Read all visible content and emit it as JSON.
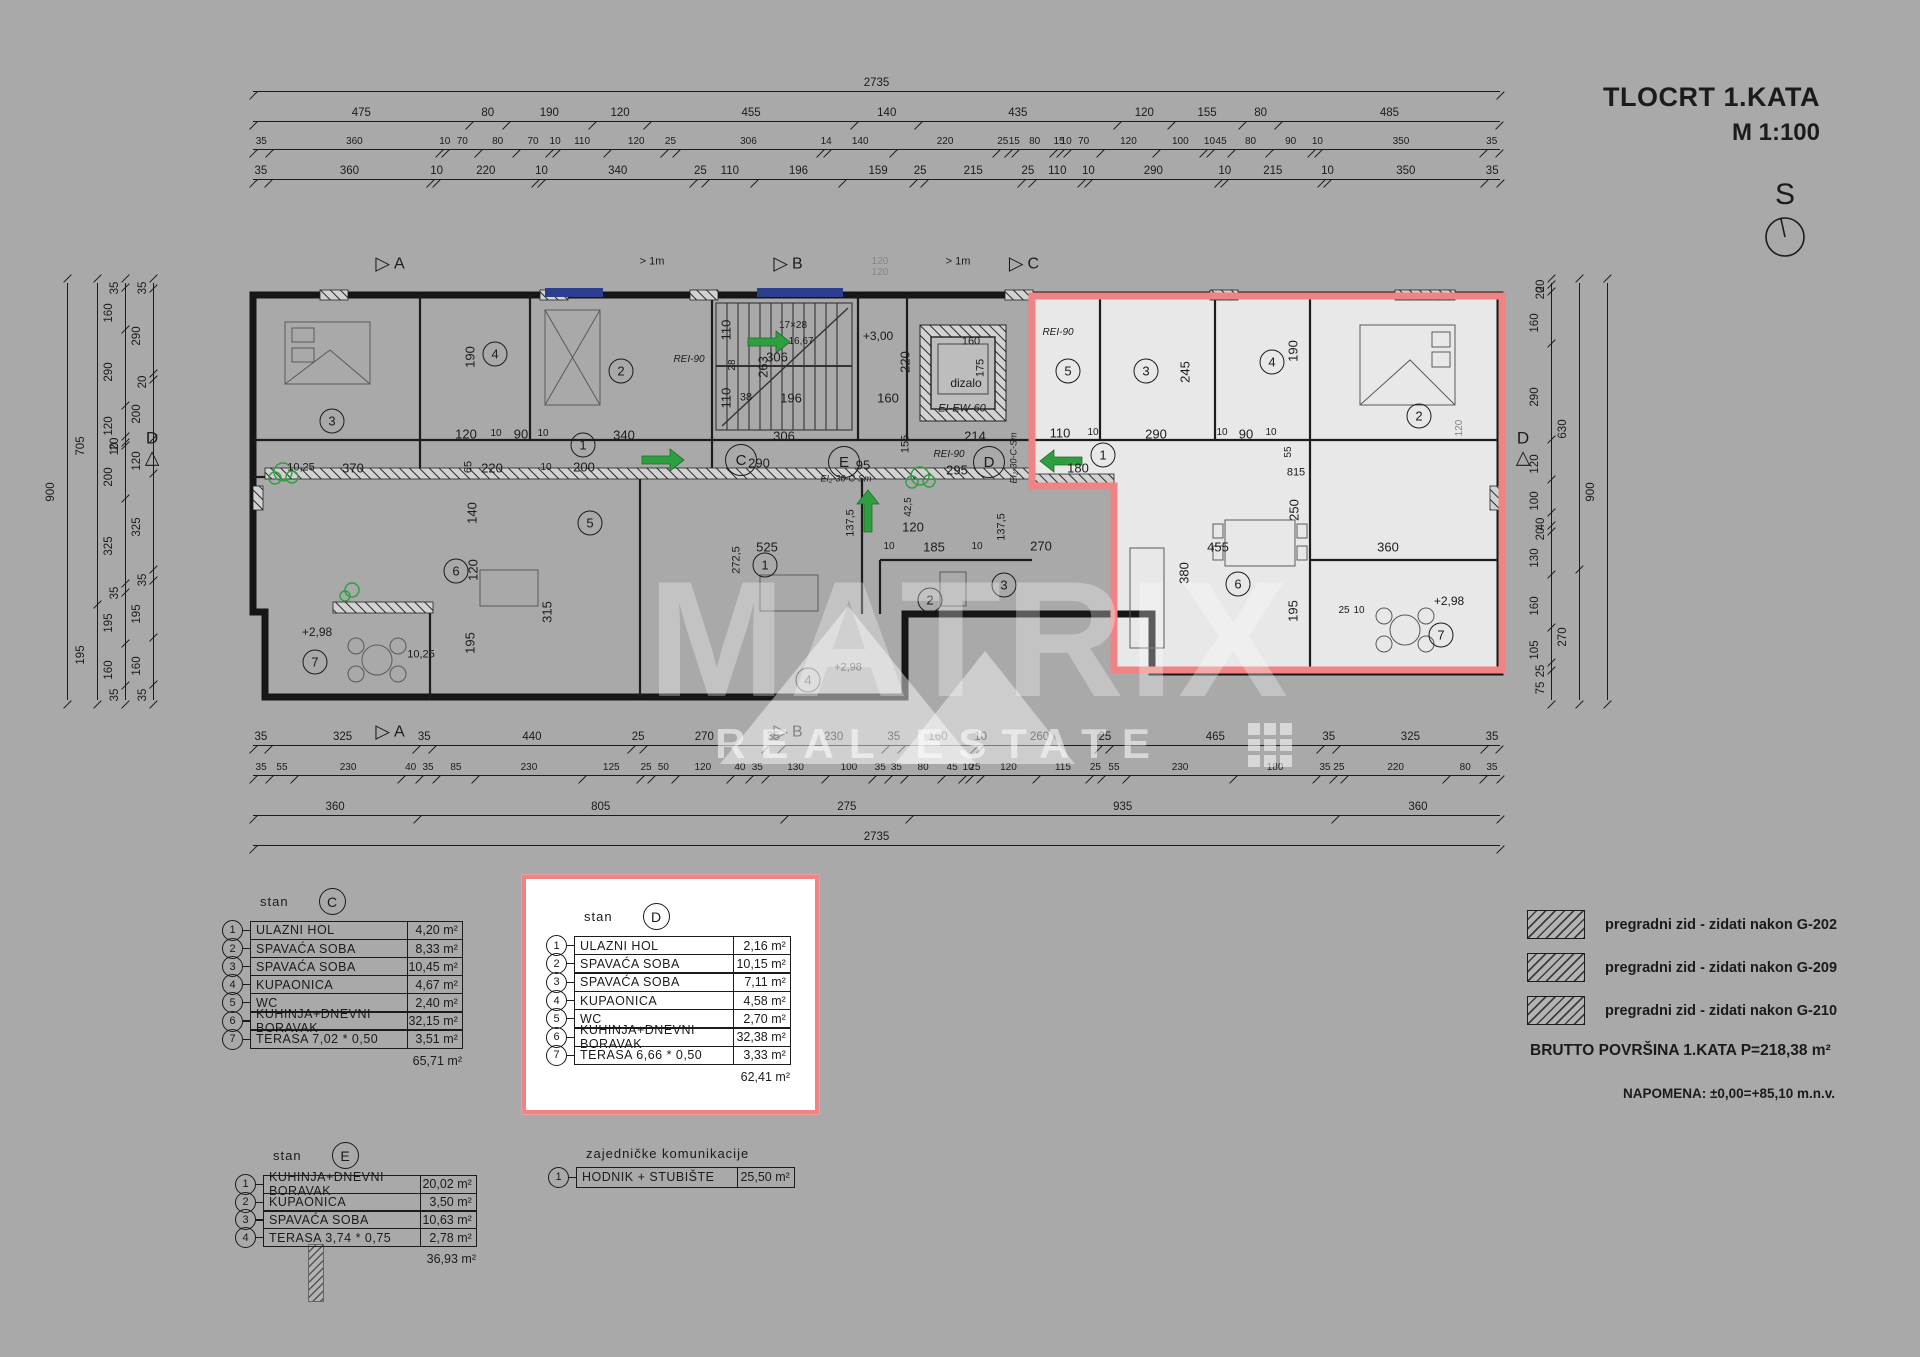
{
  "title": {
    "line1": "TLOCRT 1.KATA",
    "line2": "M 1:100"
  },
  "compass": {
    "label": "S"
  },
  "watermark": {
    "brand": "MATRIX",
    "sub": "REAL ESTATE"
  },
  "summary": {
    "brutto": "BRUTTO POVRŠINA 1.KATA  P=218,38 m²",
    "napomena": "NAPOMENA: ±0,00=+85,10 m.n.v."
  },
  "legend": {
    "items": [
      "pregradni zid - zidati nakon G-202",
      "pregradni zid - zidati nakon G-209",
      "pregradni zid - zidati nakon G-210"
    ]
  },
  "tables": [
    {
      "id": "stan-c",
      "x": 222,
      "y": 888,
      "label": "stan",
      "letter": "C",
      "red": false,
      "rowH": 19.3,
      "nameW": 158,
      "areaW": 56,
      "fs": 12.5,
      "rows": [
        [
          "1",
          "ULAZNI HOL",
          "4,20"
        ],
        [
          "2",
          "SPAVAĆA SOBA",
          "8,33"
        ],
        [
          "3",
          "SPAVAĆA SOBA",
          "10,45"
        ],
        [
          "4",
          "KUPAONICA",
          "4,67"
        ],
        [
          "5",
          "WC",
          "2,40"
        ],
        [
          "6",
          "KUHINJA+DNEVNI BORAVAK",
          "32,15"
        ],
        [
          "7",
          "TERASA 7,02 * 0,50",
          "3,51"
        ]
      ],
      "total": "65,71",
      "unit": "m²"
    },
    {
      "id": "stan-d",
      "x": 522,
      "y": 875,
      "label": "stan",
      "letter": "D",
      "red": true,
      "rowH": 19.5,
      "nameW": 160,
      "areaW": 58,
      "fs": 12.5,
      "rows": [
        [
          "1",
          "ULAZNI HOL",
          "2,16"
        ],
        [
          "2",
          "SPAVAĆA SOBA",
          "10,15"
        ],
        [
          "3",
          "SPAVAĆA SOBA",
          "7,11"
        ],
        [
          "4",
          "KUPAONICA",
          "4,58"
        ],
        [
          "5",
          "WC",
          "2,70"
        ],
        [
          "6",
          "KUHINJA+DNEVNI BORAVAK",
          "32,38"
        ],
        [
          "7",
          "TERASA 6,66 * 0,50",
          "3,33"
        ]
      ],
      "total": "62,41",
      "unit": "m²"
    },
    {
      "id": "stan-e",
      "x": 235,
      "y": 1142,
      "label": "stan",
      "letter": "E",
      "red": false,
      "rowH": 19,
      "nameW": 158,
      "areaW": 57,
      "fs": 12.5,
      "rows": [
        [
          "1",
          "KUHINJA+DNEVNI BORAVAK",
          "20,02"
        ],
        [
          "2",
          "KUPAONICA",
          "3,50"
        ],
        [
          "3",
          "SPAVAĆA SOBA",
          "10,63"
        ],
        [
          "4",
          "TERASA 3,74 * 0,75",
          "2,78"
        ]
      ],
      "total": "36,93",
      "unit": "m²"
    },
    {
      "id": "common",
      "x": 548,
      "y": 1146,
      "label": "zajedničke komunikacije",
      "letter": "",
      "red": false,
      "rowH": 21,
      "nameW": 162,
      "areaW": 58,
      "fs": 12.5,
      "rows": [
        [
          "1",
          "HODNIK + STUBIŠTE",
          "25,50"
        ]
      ],
      "total": "",
      "unit": "m²"
    }
  ],
  "dims": {
    "top": [
      {
        "y": 88,
        "segs": [
          "2735"
        ]
      },
      {
        "y": 118,
        "segs": [
          "475",
          "80",
          "190",
          "120",
          "455",
          "140",
          "435",
          "120",
          "155",
          "80",
          "485"
        ]
      },
      {
        "y": 146,
        "segs": [
          "35",
          "360",
          "10",
          "70",
          "80",
          "70",
          "10",
          "110",
          "120",
          "25",
          "306",
          "14",
          "140",
          "220",
          "25",
          "15",
          "80",
          "15",
          "10",
          "70",
          "120",
          "100",
          "10",
          "45",
          "80",
          "90",
          "10",
          "350",
          "35"
        ]
      },
      {
        "y": 176,
        "segs": [
          "35",
          "360",
          "10",
          "220",
          "10",
          "340",
          "25",
          "110",
          "196",
          "159",
          "25",
          "215",
          "25",
          "110",
          "10",
          "290",
          "10",
          "215",
          "10",
          "350",
          "35"
        ]
      }
    ],
    "bottom": [
      {
        "y": 742,
        "segs": [
          "35",
          "325",
          "35",
          "440",
          "25",
          "270",
          "35",
          "230",
          "35",
          "160",
          "10",
          "260",
          "25",
          "465",
          "35",
          "325",
          "35"
        ]
      },
      {
        "y": 772,
        "segs": [
          "35",
          "55",
          "230",
          "40",
          "35",
          "85",
          "230",
          "125",
          "25",
          "50",
          "120",
          "40",
          "35",
          "130",
          "100",
          "35",
          "35",
          "80",
          "45",
          "10",
          "25",
          "120",
          "115",
          "25",
          "55",
          "230",
          "180",
          "35",
          "25",
          "220",
          "80",
          "35"
        ]
      },
      {
        "y": 812,
        "segs": [
          "360",
          "805",
          "275",
          "935",
          "360"
        ]
      },
      {
        "y": 842,
        "segs": [
          "2735"
        ]
      }
    ],
    "left": [
      {
        "x": 64,
        "segs": [
          "900"
        ]
      },
      {
        "x": 94,
        "segs": [
          "705",
          "195"
        ]
      },
      {
        "x": 122,
        "segs": [
          "35",
          "160",
          "290",
          "120",
          "20",
          "10",
          "200",
          "325",
          "35",
          "195",
          "160",
          "35"
        ]
      },
      {
        "x": 150,
        "segs": [
          "35",
          "290",
          "20",
          "200",
          "120",
          "325",
          "35",
          "195",
          "160",
          "35"
        ]
      }
    ],
    "right": [
      {
        "x": 1548,
        "segs": [
          "20",
          "20",
          "160",
          "290",
          "120",
          "100",
          "40",
          "20",
          "130",
          "160",
          "105",
          "25",
          "75"
        ]
      },
      {
        "x": 1576,
        "segs": [
          "630",
          "270"
        ]
      },
      {
        "x": 1604,
        "segs": [
          "900"
        ]
      }
    ]
  },
  "plan_labels": [
    {
      "t": "370",
      "x": 353,
      "y": 468
    },
    {
      "t": "10,25",
      "x": 301,
      "y": 468,
      "s": 11
    },
    {
      "t": "190",
      "x": 470,
      "y": 357,
      "r": 1
    },
    {
      "t": "120",
      "x": 466,
      "y": 434
    },
    {
      "t": "10",
      "x": 496,
      "y": 434,
      "s": 10
    },
    {
      "t": "90",
      "x": 521,
      "y": 434
    },
    {
      "t": "10",
      "x": 543,
      "y": 434,
      "s": 10
    },
    {
      "t": "340",
      "x": 624,
      "y": 435
    },
    {
      "t": "65",
      "x": 469,
      "y": 467,
      "r": 1,
      "s": 11
    },
    {
      "t": "220",
      "x": 492,
      "y": 468
    },
    {
      "t": "10",
      "x": 546,
      "y": 468,
      "s": 10
    },
    {
      "t": "200",
      "x": 584,
      "y": 467
    },
    {
      "t": "306",
      "x": 777,
      "y": 357
    },
    {
      "t": "263",
      "x": 763,
      "y": 367,
      "r": 1
    },
    {
      "t": "110",
      "x": 726,
      "y": 330,
      "r": 1
    },
    {
      "t": "28",
      "x": 733,
      "y": 365,
      "r": 1,
      "s": 10
    },
    {
      "t": "110",
      "x": 726,
      "y": 398,
      "r": 1
    },
    {
      "t": "38",
      "x": 746,
      "y": 398,
      "s": 11
    },
    {
      "t": "196",
      "x": 791,
      "y": 398
    },
    {
      "t": "306",
      "x": 784,
      "y": 436
    },
    {
      "t": "17×28",
      "x": 793,
      "y": 326,
      "s": 10
    },
    {
      "t": "16,67",
      "x": 801,
      "y": 342,
      "s": 10
    },
    {
      "t": "REI-90",
      "x": 689,
      "y": 360,
      "s": 10,
      "i": 1
    },
    {
      "t": "+3,00",
      "x": 878,
      "y": 336,
      "s": 12
    },
    {
      "t": "220",
      "x": 905,
      "y": 362,
      "r": 1
    },
    {
      "t": "160",
      "x": 888,
      "y": 398
    },
    {
      "t": "155",
      "x": 906,
      "y": 444,
      "r": 1,
      "s": 11
    },
    {
      "t": "214",
      "x": 975,
      "y": 436
    },
    {
      "t": "160",
      "x": 971,
      "y": 342,
      "s": 11
    },
    {
      "t": "175",
      "x": 981,
      "y": 368,
      "r": 1,
      "s": 11
    },
    {
      "t": "dizalo",
      "x": 966,
      "y": 383,
      "s": 12
    },
    {
      "t": "EI-EW-60",
      "x": 962,
      "y": 409,
      "s": 11,
      "i": 1
    },
    {
      "t": "290",
      "x": 759,
      "y": 463
    },
    {
      "t": "95",
      "x": 863,
      "y": 465
    },
    {
      "t": "295",
      "x": 957,
      "y": 470
    },
    {
      "t": "REI-90",
      "x": 949,
      "y": 455,
      "s": 10,
      "i": 1
    },
    {
      "t": "EI₂-30-C-Sm",
      "x": 846,
      "y": 479,
      "s": 9,
      "i": 1
    },
    {
      "t": "EI₂-30-C-Sm",
      "x": 1014,
      "y": 458,
      "r": 1,
      "s": 9,
      "i": 1
    },
    {
      "t": "+2,98",
      "x": 317,
      "y": 632,
      "s": 12
    },
    {
      "t": "10,25",
      "x": 421,
      "y": 655,
      "s": 11
    },
    {
      "t": "140",
      "x": 472,
      "y": 513,
      "r": 1
    },
    {
      "t": "120",
      "x": 473,
      "y": 570,
      "r": 1
    },
    {
      "t": "315",
      "x": 547,
      "y": 612,
      "r": 1
    },
    {
      "t": "195",
      "x": 470,
      "y": 643,
      "r": 1
    },
    {
      "t": "525",
      "x": 767,
      "y": 547
    },
    {
      "t": "272,5",
      "x": 737,
      "y": 560,
      "r": 1,
      "s": 11
    },
    {
      "t": "137,5",
      "x": 851,
      "y": 523,
      "r": 1,
      "s": 11
    },
    {
      "t": "42,5",
      "x": 909,
      "y": 507,
      "r": 1,
      "s": 10
    },
    {
      "t": "120",
      "x": 913,
      "y": 527
    },
    {
      "t": "10",
      "x": 889,
      "y": 547,
      "s": 10
    },
    {
      "t": "185",
      "x": 934,
      "y": 547
    },
    {
      "t": "10",
      "x": 977,
      "y": 547,
      "s": 10
    },
    {
      "t": "137,5",
      "x": 1002,
      "y": 527,
      "r": 1,
      "s": 11
    },
    {
      "t": "270",
      "x": 1041,
      "y": 546
    },
    {
      "t": "+2,98",
      "x": 848,
      "y": 668,
      "s": 11
    },
    {
      "t": "110",
      "x": 1060,
      "y": 433
    },
    {
      "t": "10",
      "x": 1093,
      "y": 433,
      "s": 10
    },
    {
      "t": "290",
      "x": 1156,
      "y": 434
    },
    {
      "t": "10",
      "x": 1222,
      "y": 433,
      "s": 10
    },
    {
      "t": "90",
      "x": 1246,
      "y": 434
    },
    {
      "t": "10",
      "x": 1271,
      "y": 433,
      "s": 10
    },
    {
      "t": "245",
      "x": 1185,
      "y": 372,
      "r": 1
    },
    {
      "t": "190",
      "x": 1293,
      "y": 351,
      "r": 1
    },
    {
      "t": "180",
      "x": 1078,
      "y": 468
    },
    {
      "t": "REI-90",
      "x": 1058,
      "y": 333,
      "s": 10,
      "i": 1
    },
    {
      "t": "55",
      "x": 1289,
      "y": 452,
      "r": 1,
      "s": 10
    },
    {
      "t": "815",
      "x": 1296,
      "y": 473,
      "s": 11
    },
    {
      "t": "455",
      "x": 1218,
      "y": 547
    },
    {
      "t": "360",
      "x": 1388,
      "y": 547
    },
    {
      "t": "380",
      "x": 1184,
      "y": 573,
      "r": 1
    },
    {
      "t": "250",
      "x": 1294,
      "y": 510,
      "r": 1
    },
    {
      "t": "195",
      "x": 1293,
      "y": 611,
      "r": 1
    },
    {
      "t": "+2,98",
      "x": 1449,
      "y": 601,
      "s": 12
    },
    {
      "t": "25",
      "x": 1344,
      "y": 611,
      "s": 10
    },
    {
      "t": "10",
      "x": 1359,
      "y": 611,
      "s": 10
    },
    {
      "t": "> 1m",
      "x": 652,
      "y": 262,
      "s": 11
    },
    {
      "t": "> 1m",
      "x": 958,
      "y": 262,
      "s": 11
    },
    {
      "t": "120",
      "x": 880,
      "y": 262,
      "s": 10,
      "c": "#868686"
    },
    {
      "t": "120",
      "x": 880,
      "y": 273,
      "s": 10,
      "c": "#868686"
    },
    {
      "t": "120",
      "x": 1460,
      "y": 428,
      "r": 1,
      "s": 10,
      "c": "#868686"
    }
  ],
  "rooms": [
    {
      "n": "3",
      "x": 332,
      "y": 421
    },
    {
      "n": "4",
      "x": 495,
      "y": 354
    },
    {
      "n": "2",
      "x": 621,
      "y": 371
    },
    {
      "n": "5",
      "x": 590,
      "y": 523
    },
    {
      "n": "1",
      "x": 583,
      "y": 445
    },
    {
      "n": "6",
      "x": 456,
      "y": 571
    },
    {
      "n": "7",
      "x": 315,
      "y": 662
    },
    {
      "n": "1",
      "x": 765,
      "y": 565
    },
    {
      "n": "2",
      "x": 930,
      "y": 600
    },
    {
      "n": "3",
      "x": 1004,
      "y": 585
    },
    {
      "n": "4",
      "x": 808,
      "y": 680
    },
    {
      "n": "5",
      "x": 1068,
      "y": 371
    },
    {
      "n": "3",
      "x": 1146,
      "y": 371
    },
    {
      "n": "4",
      "x": 1272,
      "y": 362
    },
    {
      "n": "2",
      "x": 1419,
      "y": 416
    },
    {
      "n": "1",
      "x": 1103,
      "y": 455
    },
    {
      "n": "6",
      "x": 1238,
      "y": 584
    },
    {
      "n": "7",
      "x": 1441,
      "y": 635
    }
  ],
  "section_circles": [
    {
      "l": "C",
      "x": 741,
      "y": 460
    },
    {
      "l": "E",
      "x": 844,
      "y": 462
    },
    {
      "l": "D",
      "x": 989,
      "y": 462
    }
  ],
  "markers": [
    {
      "l": "A",
      "x": 390,
      "y": 264
    },
    {
      "l": "B",
      "x": 788,
      "y": 264
    },
    {
      "l": "C",
      "x": 1024,
      "y": 264
    },
    {
      "l": "A",
      "x": 390,
      "y": 732
    },
    {
      "l": "B",
      "x": 788,
      "y": 732
    },
    {
      "l": "D",
      "x": 152,
      "y": 448,
      "side": 1
    },
    {
      "l": "D",
      "x": 1523,
      "y": 448,
      "side": 1
    }
  ],
  "colors": {
    "bg": "#a9a9a9",
    "line": "#1d1d1d",
    "red": "#f08484",
    "green": "#2f9e41",
    "blue": "#2b3f8e"
  }
}
